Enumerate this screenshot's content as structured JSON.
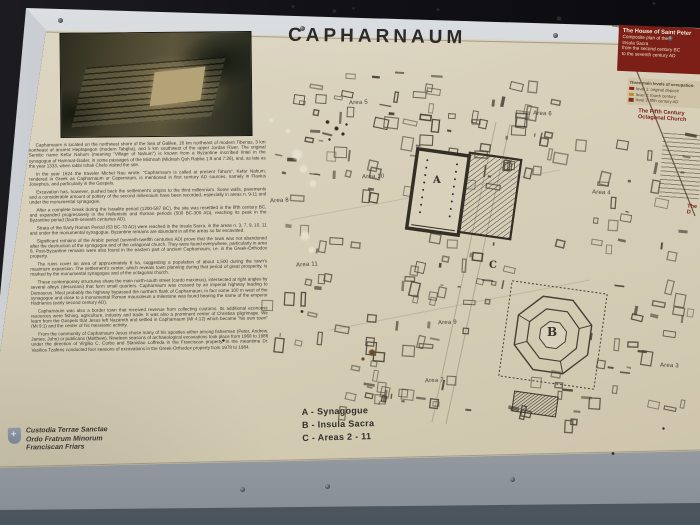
{
  "sign": {
    "title": "CAPHARNAUM",
    "intro_paragraphs": [
      "Capharnaum is located on the northwest shore of the Sea of Galilee, 16 km northeast of modern Tiberias, 3 km northeast of ancient Heptapegon (modern Tabgha), and 5 km southwest of the upper Jordan River. The original Semitic name Kefar Nahum (meaning \"Village of Nahum\") is known from a Byzantine inscribed lintel in the synagogue of Hammat-Gader, in some passages of the Mishnah (Midrash Qoh Rabba 1:8 and 7:26), and, as late as the year 1333, when rabbi Ishak Chelo visited the site.",
      "In the year 1624 the traveler Michel Nau wrote: \"Capharnaum is called at present Tahum\". Kefar Nahum, rendered in Greek as Capharnaum or Capernaum, is mentioned in first century AD sources, namely in Flavius Josephus, and particularly in the Gospels.",
      "Excavation has, however, pushed back the settlement's origins to the third millennium. Some walls, pavements and a considerable amount of pottery of the second millennium have been recorded, especially in areas n. 9-11 and under the monumental synagogue.",
      "After a complete break during the Israelite period (1200-587 BC), the site was resettled in the fifth century BC, and expanded progressively in the Hellenistic and Roman periods (500 BC-300 AD), reaching its peak in the Byzantine period (fourth-seventh centuries AD).",
      "Strata of the Early Roman Period (63 BC-70 AD) were reached in the Insula Sacra, in the areas n. 3, 7, 9, 10, 11 and under the monumental synagogue. Byzantine remains are abundant in all the areas so far excavated.",
      "Significant remains of the Arabic period (seventh-twelfth centuries AD) prove that the town was not abandoned after the destruction of the synagogue and of the octagonal church. They were found everywhere, particularly in area 8. Post-Byzantine remains were also found in the eastern part of ancient Capharnaum, i.e. in the Greek-Orthodox property.",
      "The ruins cover an area of approximately 6 ha, suggesting a population of about 1,500 during the town's maximum expansion. The settlement's center, which reveals town planning during that period of great prosperity, is marked by the monumental synagogue and of the octagonal church.",
      "These contemporary structures share the main north-south street (cardo maximus), intersected at right angles by several alleys (decumani) that form small quarters. Capharnaum was crossed by an imperial highway leading to Damascus. Most probably the highway bypassed the northern flank of Capharnaum; in fact some 100 m west of the synagogue and close to a monumental Roman mausoleum a milestone was found bearing the name of the emperor Hadrianus (early second century AD).",
      "Capharnaum was also a border town that received revenue from collecting customs. Its additional economic resources were fishing, agriculture, industry and trade. It was also a prominent center of Christian pilgrimage. We learn from the Gospels that Jesus left Nazareth and settled in Capharnaum (Mt 4:12) which became \"his own town\" (Mt 9:1) and the center of his messianic activity.",
      "From the community of Capharnaum Jesus chose many of his apostles either among fishermen (Peter, Andrew, James, John) or publicans (Matthew). Nineteen seasons of archaeological excavations took place from 1968 to 1986 under the direction of Virgilio C. Corbo and Stanislao Loffreda in the Franciscan property. In the meantime Dr. Vasilios Tzaferis conducted four seasons of excavations in the Greek-Orthodox property from 1978 to 1984."
    ],
    "credits_lines": [
      "Custodia Terrae Sanctae",
      "Ordo Fratrum Minorum",
      "Franciscan Friars"
    ],
    "map": {
      "area_labels": [
        {
          "label": "Area 5",
          "x": 349,
          "y": 100,
          "r": -2
        },
        {
          "label": "Area 6",
          "x": 533,
          "y": 111,
          "r": 3
        },
        {
          "label": "Area 10",
          "x": 362,
          "y": 174,
          "r": -2
        },
        {
          "label": "Area 4",
          "x": 592,
          "y": 190,
          "r": 3
        },
        {
          "label": "Area 8",
          "x": 270,
          "y": 198,
          "r": -3
        },
        {
          "label": "Area 11",
          "x": 296,
          "y": 262,
          "r": -3
        },
        {
          "label": "Area 9",
          "x": 438,
          "y": 320,
          "r": -2
        },
        {
          "label": "Area 3",
          "x": 660,
          "y": 363,
          "r": 2
        },
        {
          "label": "Area 7",
          "x": 425,
          "y": 378,
          "r": -2
        }
      ],
      "building_labels": [
        {
          "label": "A",
          "x": 433,
          "y": 175,
          "size": 10
        },
        {
          "label": "B",
          "x": 547,
          "y": 325,
          "size": 12
        },
        {
          "label": "C",
          "x": 489,
          "y": 260,
          "size": 10
        }
      ],
      "legend_lines": [
        "A - Synagogue",
        "B - Insula Sacra",
        "C - Areas 2 - 11"
      ]
    },
    "sidebar": {
      "header_title": "The House of Saint Peter",
      "header_lines": [
        "Composite plan of the",
        "Insula Sacra",
        "from the second century BC",
        "to the seventh century AD"
      ],
      "levels_title": "Three main levels of occupation:",
      "levels": [
        {
          "color": "#8a2418",
          "label": "level 1: original deposit"
        },
        {
          "color": "#c28a30",
          "label": "level 2: fourth century"
        },
        {
          "color": "#7a3018",
          "label": "level 3: fifth century AD"
        }
      ],
      "section2_title": "The Fifth Century Octagonal Church",
      "section3_fragment": "The\nD"
    }
  },
  "colors": {
    "panel_cream": "#d7cfb8",
    "sidebar_red": "#7c2017",
    "frame_silver": "#c3c8cc",
    "wall_bottom_gray": "#5d6770",
    "wall_top_dark": "#141417",
    "map_ink": "#463f34",
    "title_ink": "#2d2a25"
  }
}
